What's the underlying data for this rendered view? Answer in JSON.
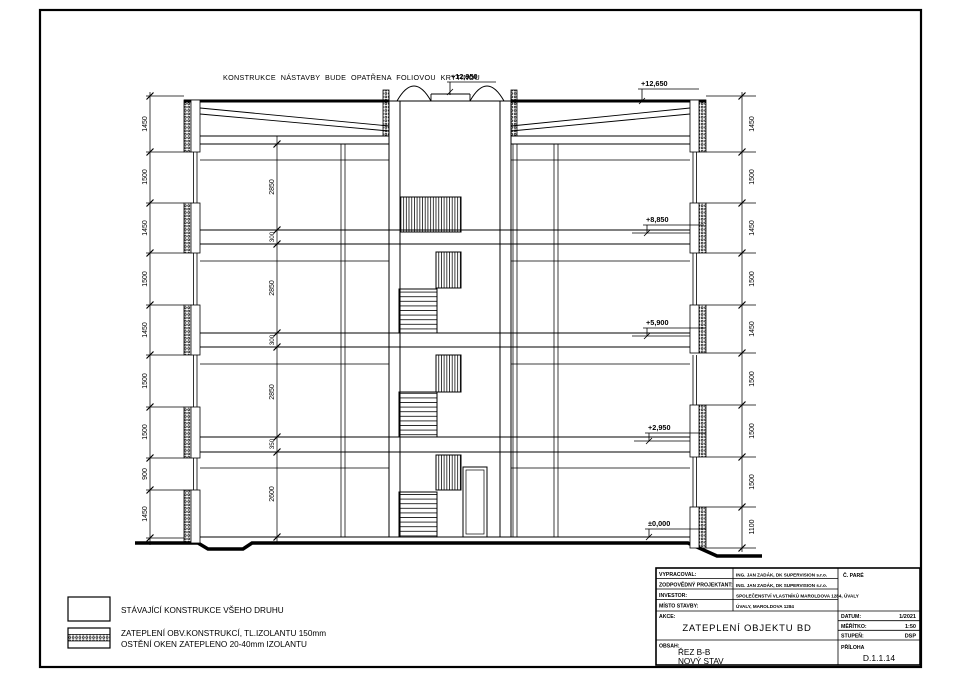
{
  "drawing": {
    "annotation_roof": "KONSTRUKCE NÁSTAVBY BUDE OPATŘENA FOLIOVOU KRYTINOU",
    "elevations": {
      "ridge": "+12,950",
      "roof_edge": "+12,650",
      "level_4": "+8,850",
      "level_3": "+5,900",
      "level_2": "+2,950",
      "level_0": "±0,000"
    },
    "dim_left": [
      "1450",
      "1500",
      "1450",
      "1500",
      "1450",
      "1500",
      "1500",
      "900",
      "1450"
    ],
    "dim_right": [
      "1450",
      "1500",
      "1450",
      "1500",
      "1450",
      "1500",
      "1500",
      "1500",
      "1100"
    ],
    "dim_interior": [
      "2850",
      "300",
      "2850",
      "300",
      "2850",
      "350",
      "2600"
    ]
  },
  "legend": {
    "item1": "STÁVAJÍCÍ KONSTRUKCE VŠEHO DRUHU",
    "item2_line1": "ZATEPLENÍ OBV.KONSTRUKCÍ, TL.IZOLANTU 150mm",
    "item2_line2": "OSTĚNÍ OKEN ZATEPLENO 20-40mm IZOLANTU"
  },
  "title_block": {
    "rows": [
      {
        "label": "VYPRACOVAL:",
        "value": "ING. JAN ZADÁK, DK SUPERVISION s.r.o."
      },
      {
        "label": "ZODPOVĚDNÝ PROJEKTANT:",
        "value": "ING. JAN ZADÁK, DK SUPERVISION s.r.o."
      },
      {
        "label": "INVESTOR:",
        "value": "SPOLEČENSTVÍ VLASTNÍKŮ MAROLDOVA 1284, ÚVALY"
      },
      {
        "label": "MÍSTO STAVBY:",
        "value": "ÚVALY, MAROLDOVA 1284"
      }
    ],
    "pare_label": "Č. PARÉ",
    "akce_label": "AKCE:",
    "akce_value": "ZATEPLENÍ OBJEKTU BD",
    "datum_label": "DATUM:",
    "datum_value": "1/2021",
    "meritko_label": "MĚŘÍTKO:",
    "meritko_value": "1:50",
    "stupen_label": "STUPEŇ:",
    "stupen_value": "DSP",
    "obsah_label": "OBSAH:",
    "obsah_line1": "ŘEZ B-B",
    "obsah_line2": "NOVÝ STAV",
    "priloha_label": "PŘÍLOHA",
    "priloha_value": "D.1.1.14"
  }
}
